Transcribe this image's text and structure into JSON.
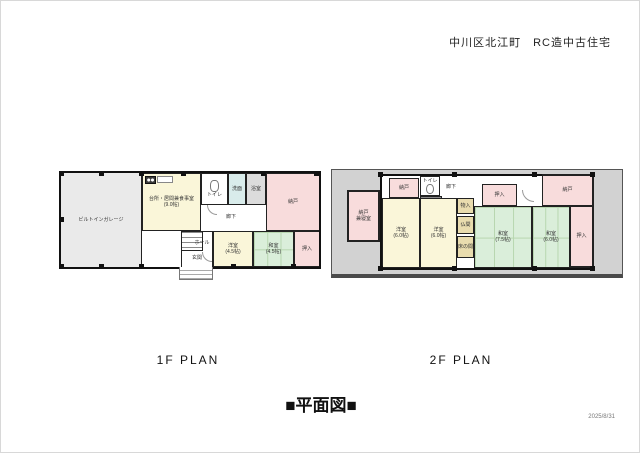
{
  "header": {
    "title": "中川区北江町　RC造中古住宅"
  },
  "floor1": {
    "title": "1F PLAN",
    "rooms": {
      "garage": {
        "label": "ビルトインガレージ"
      },
      "ldk": {
        "label": "台所・居間兼食事室",
        "size": "(9.0帖)"
      },
      "toilet": {
        "label": "トイレ"
      },
      "washroom": {
        "label": "洗面"
      },
      "bath": {
        "label": "浴室"
      },
      "corridor": {
        "label": "廊下"
      },
      "storage": {
        "label": "納戸"
      },
      "hall": {
        "label": "ホール"
      },
      "entrance": {
        "label": "玄関"
      },
      "western": {
        "label": "洋室",
        "size": "(4.5帖)"
      },
      "japanese": {
        "label": "和室",
        "size": "(4.5帖)"
      },
      "closet": {
        "label": "押入"
      }
    }
  },
  "floor2": {
    "title": "2F PLAN",
    "rooms": {
      "storage_bedroom": {
        "label": "納戸",
        "label2": "兼寝室"
      },
      "storage_top": {
        "label": "納戸"
      },
      "toilet": {
        "label": "トイレ"
      },
      "corridor": {
        "label": "廊下"
      },
      "western1": {
        "label": "洋室",
        "size": "(6.0帖)"
      },
      "western2": {
        "label": "洋室",
        "size": "(6.0帖)"
      },
      "monoire": {
        "label": "物入"
      },
      "butsuma": {
        "label": "仏間"
      },
      "tokonoma": {
        "label": "床の間"
      },
      "closet_top": {
        "label": "押入"
      },
      "storage_right": {
        "label": "納戸"
      },
      "japanese1": {
        "label": "和室",
        "size": "(7.5帖)"
      },
      "japanese2": {
        "label": "和室",
        "size": "(6.0帖)"
      },
      "closet_right": {
        "label": "押入"
      }
    }
  },
  "footer": {
    "caption": "■平面図■",
    "date": "2025/8/31"
  },
  "colors": {
    "wall": "#1a1a1a",
    "room_yellow": "#faf6d9",
    "room_green": "#daeeda",
    "room_pink": "#f8dcdc",
    "room_gray": "#dcdcdc",
    "room_cyan": "#d9eceb",
    "room_tan": "#e9dcae",
    "garage_gray": "#eaeaea",
    "roof_gray": "#d2d2d2"
  }
}
